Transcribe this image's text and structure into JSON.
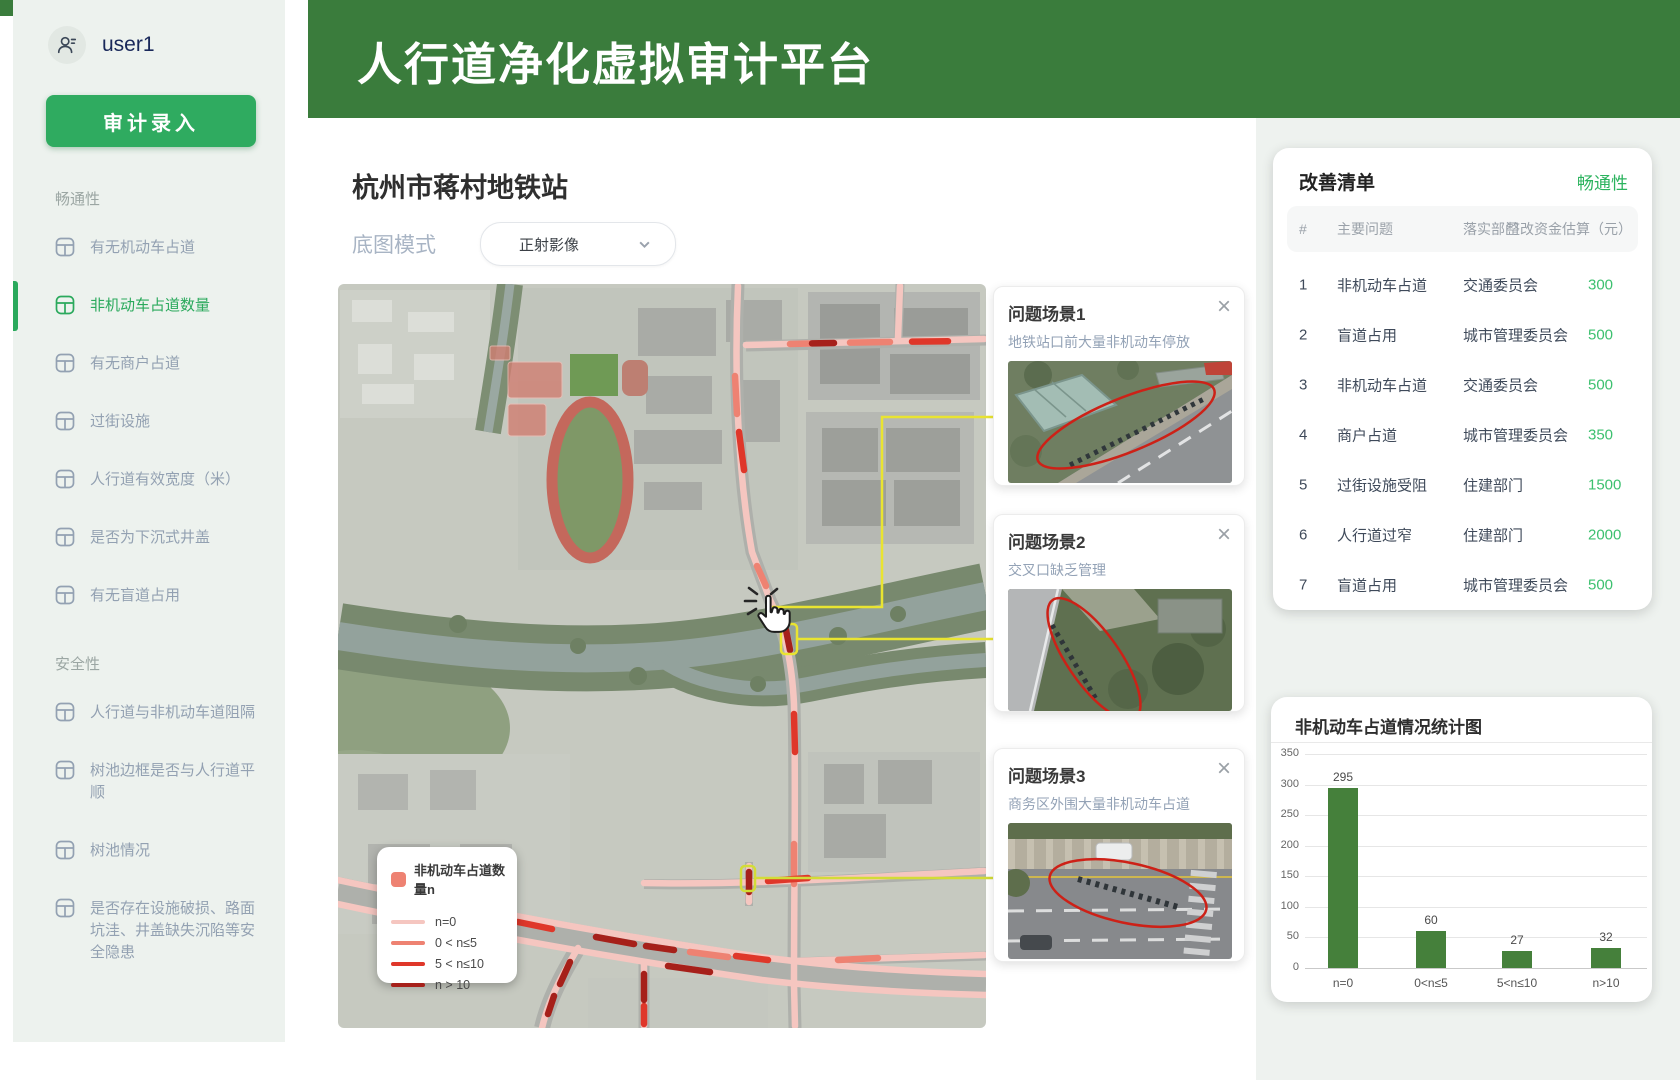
{
  "header": {
    "title": "人行道净化虚拟审计平台"
  },
  "sidebar": {
    "user": "user1",
    "audit_button": "审计录入",
    "sections": [
      {
        "label": "畅通性",
        "items": [
          {
            "label": "有无机动车占道",
            "active": false
          },
          {
            "label": "非机动车占道数量",
            "active": true
          },
          {
            "label": "有无商户占道",
            "active": false
          },
          {
            "label": "过街设施",
            "active": false
          },
          {
            "label": "人行道有效宽度（米）",
            "active": false
          },
          {
            "label": "是否为下沉式井盖",
            "active": false
          },
          {
            "label": "有无盲道占用",
            "active": false
          }
        ]
      },
      {
        "label": "安全性",
        "items": [
          {
            "label": "人行道与非机动车道阻隔",
            "active": false
          },
          {
            "label": "树池边框是否与人行道平顺",
            "active": false
          },
          {
            "label": "树池情况",
            "active": false
          },
          {
            "label": "是否存在设施破损、路面坑洼、井盖缺失沉陷等安全隐患",
            "active": false
          }
        ]
      }
    ]
  },
  "main": {
    "title": "杭州市蒋村地铁站",
    "basemap_label": "底图模式",
    "basemap_value": "正射影像",
    "legend": {
      "title": "非机动车占道数量n",
      "rows": [
        {
          "label": "n=0",
          "color": "#f5c6c0"
        },
        {
          "label": "0 < n≤5",
          "color": "#ee8272"
        },
        {
          "label": "5 < n≤10",
          "color": "#df372a"
        },
        {
          "label": "n > 10",
          "color": "#a6201a"
        }
      ]
    }
  },
  "scene_cards": [
    {
      "title": "问题场景1",
      "subtitle": "地铁站口前大量非机动车停放",
      "close": "×"
    },
    {
      "title": "问题场景2",
      "subtitle": "交叉口缺乏管理",
      "close": "×"
    },
    {
      "title": "问题场景3",
      "subtitle": "商务区外围大量非机动车占道",
      "close": "×"
    }
  ],
  "improvement_panel": {
    "title": "改善清单",
    "tag": "畅通性",
    "columns": [
      "#",
      "主要问题",
      "落实部门",
      "整改资金估算（元）"
    ],
    "rows": [
      {
        "no": "1",
        "issue": "非机动车占道",
        "dept": "交通委员会",
        "cost": "300"
      },
      {
        "no": "2",
        "issue": "盲道占用",
        "dept": "城市管理委员会",
        "cost": "500"
      },
      {
        "no": "3",
        "issue": "非机动车占道",
        "dept": "交通委员会",
        "cost": "500"
      },
      {
        "no": "4",
        "issue": "商户占道",
        "dept": "城市管理委员会",
        "cost": "350"
      },
      {
        "no": "5",
        "issue": "过街设施受阻",
        "dept": "住建部门",
        "cost": "1500"
      },
      {
        "no": "6",
        "issue": "人行道过窄",
        "dept": "住建部门",
        "cost": "2000"
      },
      {
        "no": "7",
        "issue": "盲道占用",
        "dept": "城市管理委员会",
        "cost": "500"
      }
    ]
  },
  "chart_data": {
    "type": "bar",
    "title": "非机动车占道情况统计图",
    "categories": [
      "n=0",
      "0<n≤5",
      "5<n≤10",
      "n>10"
    ],
    "values": [
      295,
      60,
      27,
      32
    ],
    "ylim": [
      0,
      350
    ],
    "yticks": [
      0,
      50,
      100,
      150,
      200,
      250,
      300,
      350
    ],
    "bar_color": "#45803b",
    "grid": true,
    "legend_position": "none",
    "xlabel": "",
    "ylabel": ""
  },
  "colors": {
    "header_green": "#3a7c3c",
    "accent_green": "#2fab60",
    "cost_green": "#3cc06f",
    "road_n0": "#f5c6c0",
    "road_low": "#ee8272",
    "road_mid": "#df372a",
    "road_high": "#a6201a",
    "connector_yellow": "#e9e431"
  }
}
